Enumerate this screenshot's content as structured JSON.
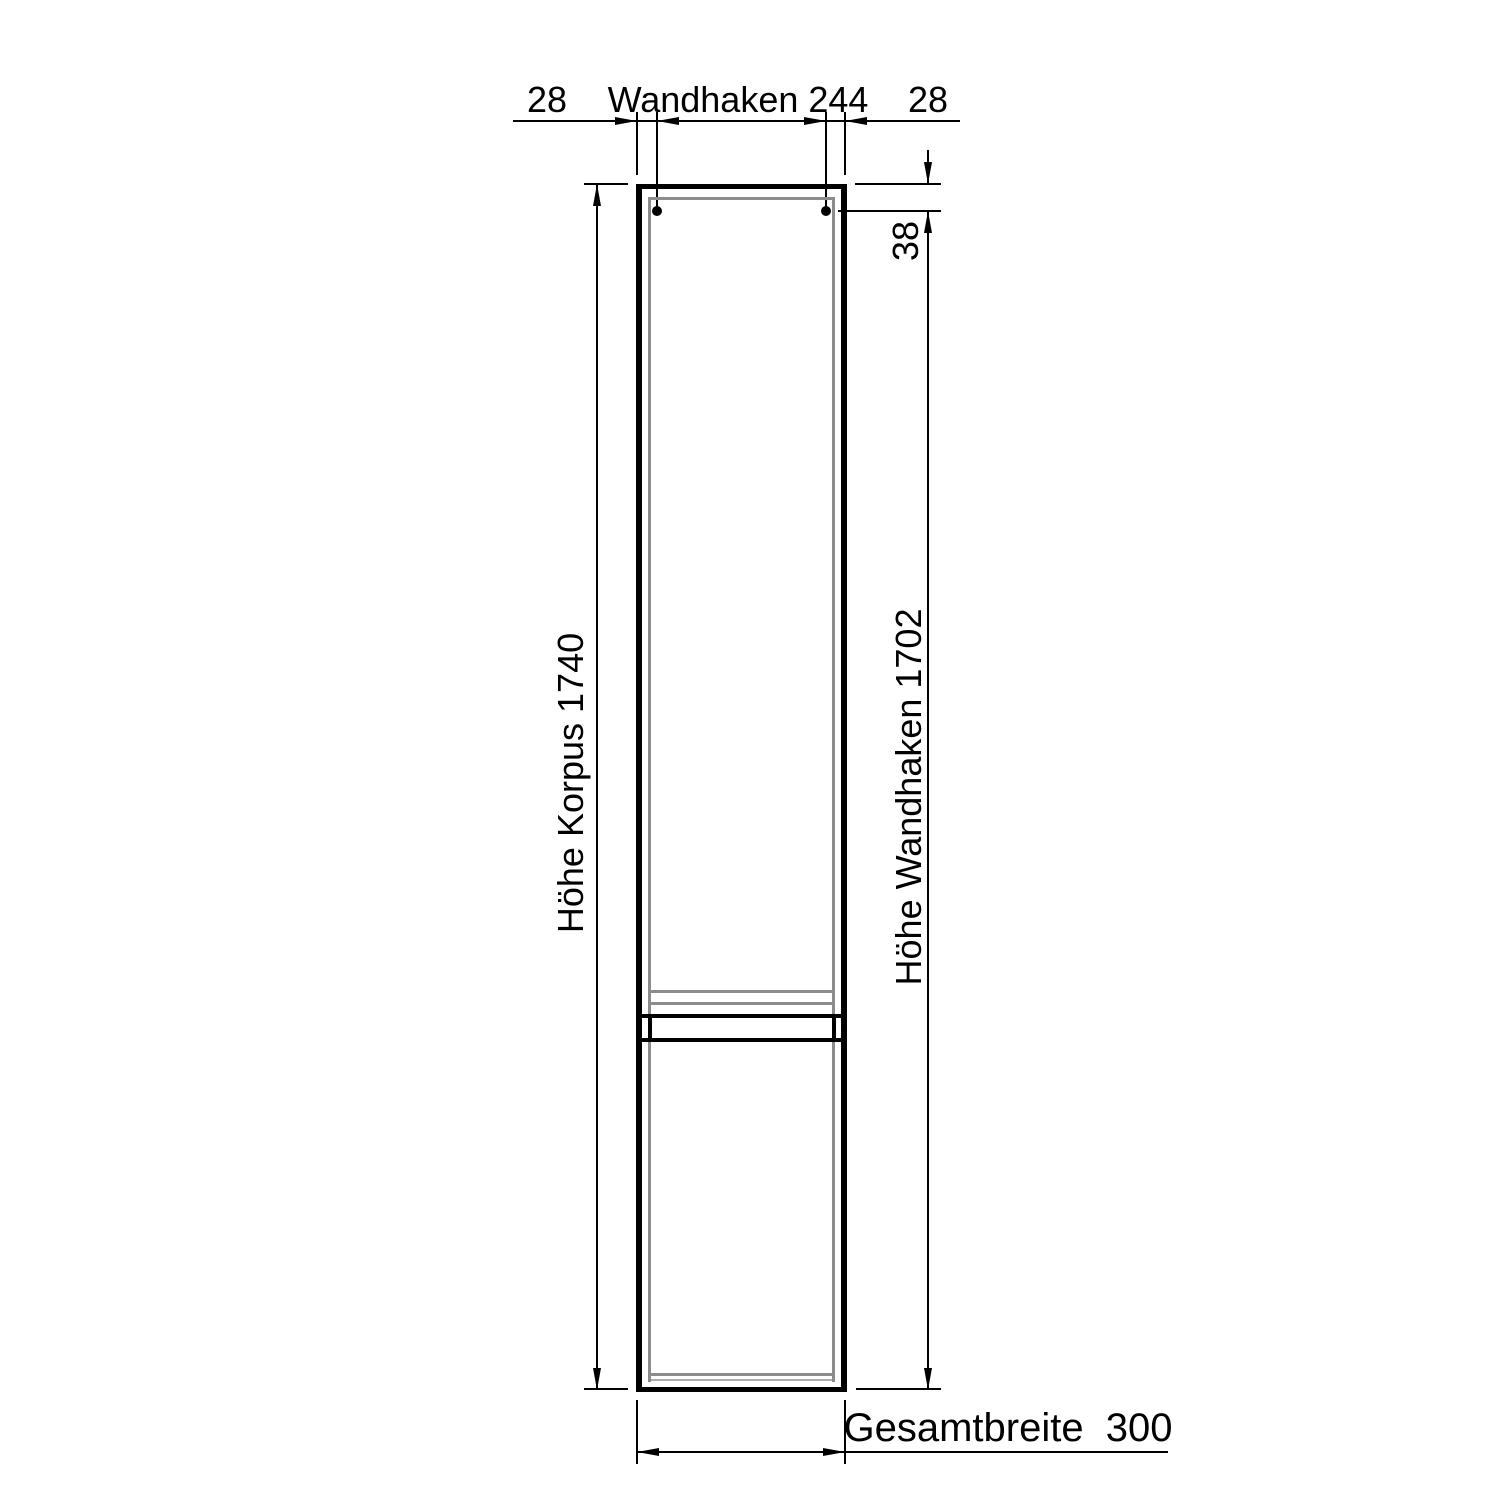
{
  "diagram": {
    "type": "technical-drawing",
    "subject": "tall cabinet front elevation with wall-hook mounting dimensions",
    "background_color": "#ffffff",
    "line_color": "#000000",
    "secondary_line_color": "#8c8c8c",
    "units_implied": "mm",
    "top_dimensions": {
      "left_offset": "28",
      "center_label": "Wandhaken 244",
      "right_offset": "28"
    },
    "left_dimension": {
      "label": "Höhe Korpus 1740"
    },
    "right_dimensions": {
      "hook_top_offset": "38",
      "label": "Höhe Wandhaken 1702"
    },
    "bottom_dimension": {
      "label": "Gesamtbreite  300"
    },
    "features": {
      "wall_hooks_count": 2
    }
  }
}
